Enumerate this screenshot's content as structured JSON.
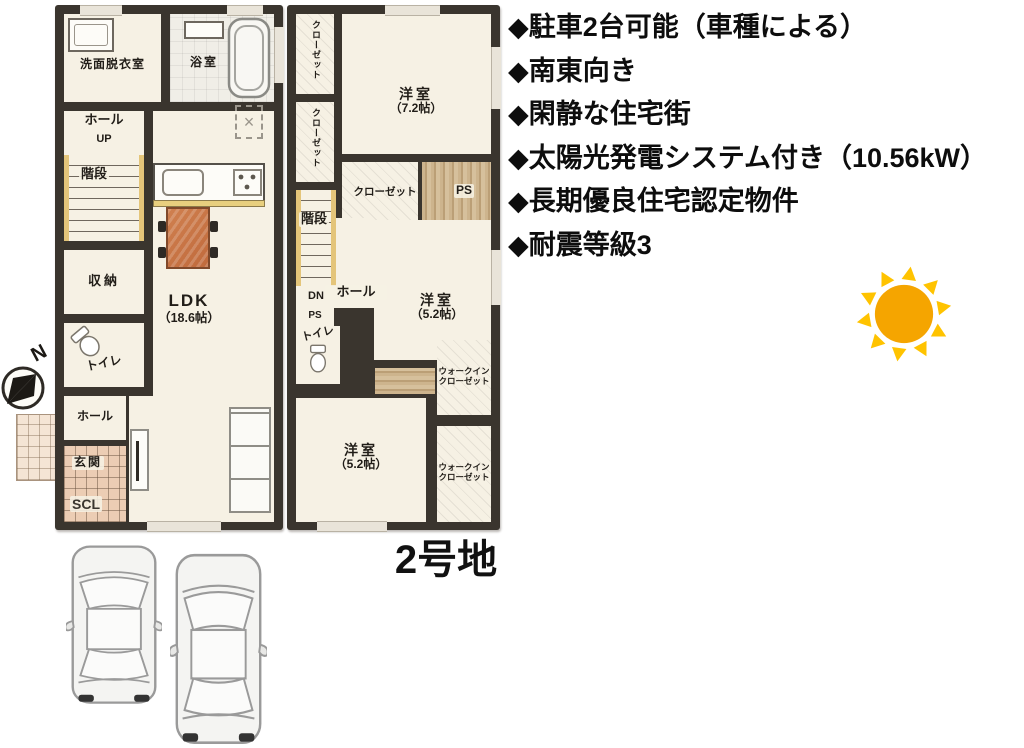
{
  "features": {
    "items": [
      "◆駐車2台可能（車種による）",
      "◆南東向き",
      "◆閑静な住宅街",
      "◆太陽光発電システム付き（10.56kW）",
      "◆長期優良住宅認定物件",
      "◆耐震等級3"
    ]
  },
  "plot": {
    "label": "2号地"
  },
  "compass": {
    "label": "N"
  },
  "floor1": {
    "washroom": "洗面脱衣室",
    "bath": "浴室",
    "hall_upper": "ホール",
    "up": "UP",
    "stairs": "階段",
    "storage": "収納",
    "toilet": "トイレ",
    "hall_lower": "ホール",
    "entrance": "玄関",
    "scl": "SCL",
    "ldk": "LDK",
    "ldk_size": "（18.6帖）"
  },
  "floor2": {
    "closet1": "クローゼット",
    "closet2": "クローゼット",
    "bedroom1": "洋室",
    "bedroom1_size": "（7.2帖）",
    "closet3": "クローゼット",
    "ps1": "PS",
    "stairs": "階段",
    "dn": "DN",
    "hall": "ホール",
    "ps2": "PS",
    "toilet": "トイレ",
    "bedroom2": "洋室",
    "bedroom2_size": "（5.2帖）",
    "wic_line1": "ウォークイン",
    "wic_line2": "クローゼット",
    "bedroom3": "洋室",
    "bedroom3_size": "（5.2帖）"
  },
  "colors": {
    "wall": "#3A352E",
    "floor": "#F6F1E4",
    "sun_core": "#F5A500",
    "sun_rays": "#FFC300",
    "dining_table": "#C9744A",
    "stairs_trim": "#E4C57A",
    "entrance_tile": "#ECCDB4",
    "wood": "#C9AE85"
  }
}
